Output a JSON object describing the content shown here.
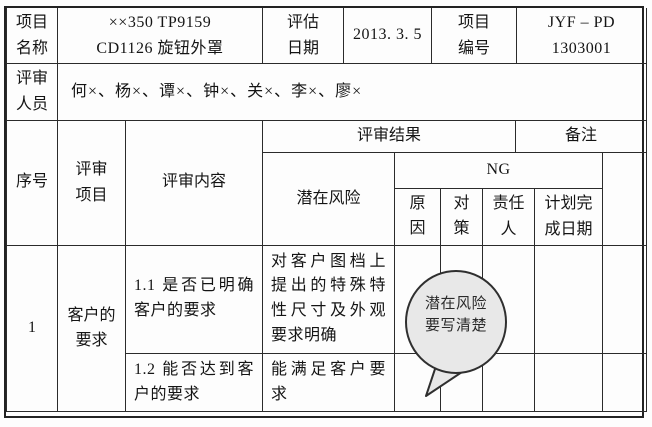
{
  "info": {
    "project_name": {
      "label": "项目名称",
      "line1": "××350 TP9159",
      "line2": "CD1126 旋钮外罩"
    },
    "eval_date": {
      "label": "评估日期",
      "value": "2013. 3. 5"
    },
    "project_no": {
      "label": "项目编号",
      "line1": "JYF – PD",
      "line2": "1303001"
    },
    "reviewers": {
      "label": "评审人员",
      "value": "何×、杨×、谭×、钟×、关×、李×、廖×"
    }
  },
  "review_table": {
    "headers": {
      "serial": "序号",
      "item": "评审项目",
      "content": "评审内容",
      "result": "评审结果",
      "remarks": "备注",
      "risk": "潜在风险",
      "ng": "NG",
      "cause": "原因",
      "measure": "对策",
      "owner": "责任人",
      "plan_date": "计划完成日期"
    },
    "group": {
      "serial": "1",
      "item": "客户的要求"
    },
    "entries": [
      {
        "content": "1.1 是否已明确客户的要求",
        "risk": "对客户图档上提出的特殊特性尺寸及外观要求明确"
      },
      {
        "content": "1.2 能否达到客户的要求",
        "risk": "能满足客户要求"
      }
    ]
  },
  "callout": {
    "line1": "潜在风险",
    "line2": "要写清楚"
  },
  "colors": {
    "line": "#2b2b2b",
    "bubble_fill": "#e8e8e8",
    "bubble_stroke": "#2f2f2f",
    "text": "#141414"
  }
}
